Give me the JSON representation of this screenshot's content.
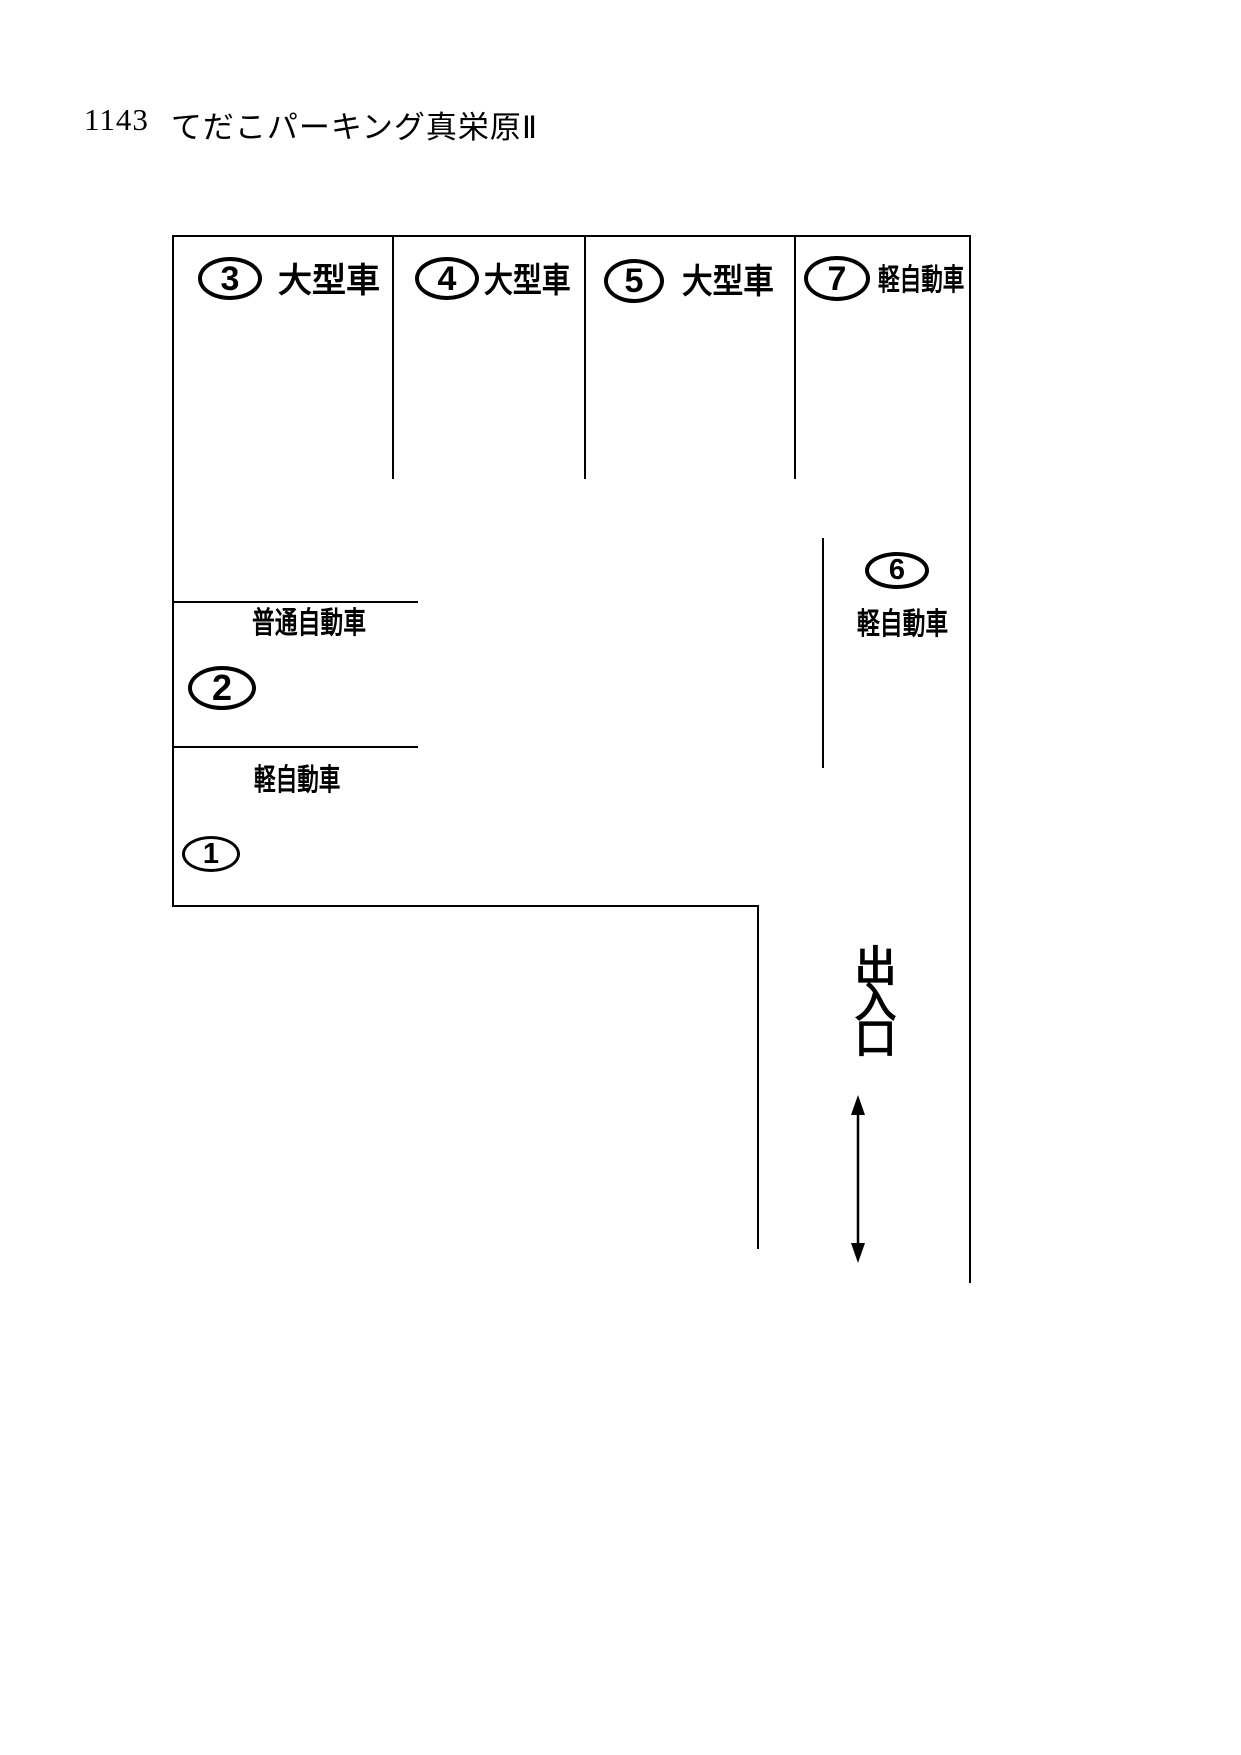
{
  "header": {
    "lot_number": "1143",
    "lot_name": "てだこパーキング真栄原Ⅱ"
  },
  "stalls": {
    "s1": {
      "number": "1",
      "type": "軽自動車"
    },
    "s2": {
      "number": "2",
      "type": "普通自動車"
    },
    "s3": {
      "number": "3",
      "type": "大型車"
    },
    "s4": {
      "number": "4",
      "type": "大型車"
    },
    "s5": {
      "number": "5",
      "type": "大型車"
    },
    "s6": {
      "number": "6",
      "type": "軽自動車"
    },
    "s7": {
      "number": "7",
      "type": "軽自動車"
    }
  },
  "entrance": {
    "label": "出入口"
  },
  "colors": {
    "line": "#000000",
    "text": "#000000",
    "background": "#ffffff"
  }
}
